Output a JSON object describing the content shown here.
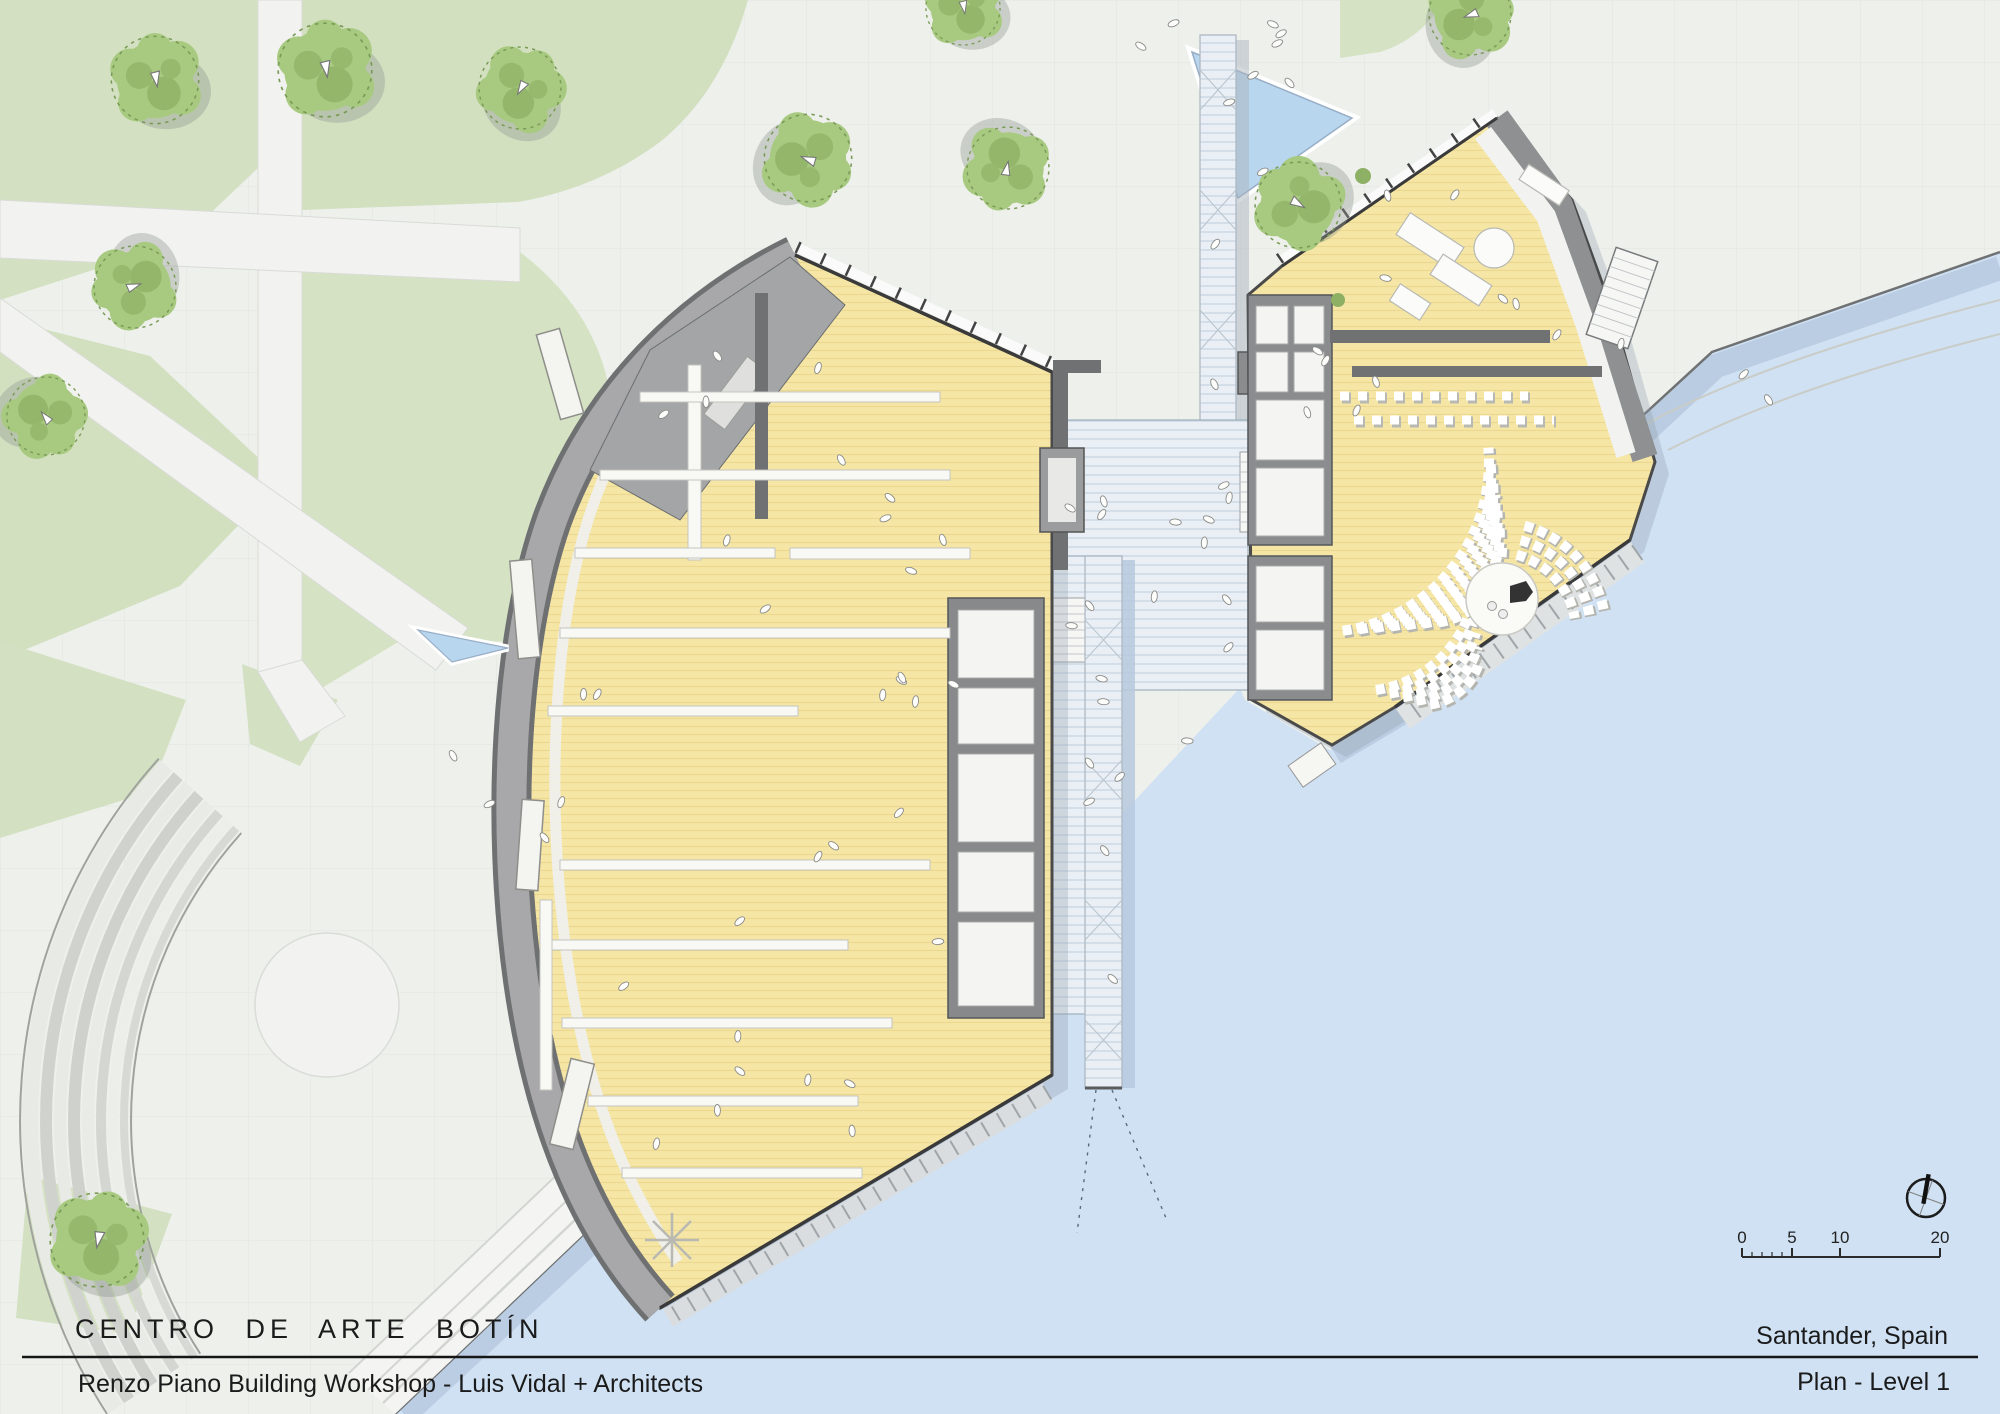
{
  "title_block": {
    "project": "CENTRO DE ARTE BOTÍN",
    "architects": "Renzo Piano Building Workshop - Luis Vidal + Architects",
    "location": "Santander, Spain",
    "sheet": "Plan - Level 1"
  },
  "scale_bar": {
    "unit_labels": [
      "0",
      "5",
      "10",
      "20"
    ]
  },
  "compass": {
    "icon": "north-arrow-icon"
  },
  "palette": {
    "paper": "#eef0ec",
    "paving_grid": "#e3e5e0",
    "lawn": "#d3e1c2",
    "tree_canopy": "#a8ca80",
    "water": "#cfe1f3",
    "water_shadow": "#b7c9de",
    "pool": "#b9d6ef",
    "gallery_floor": "#f5e6a5",
    "wall_dark": "#4a4a4a",
    "roof_gray": "#a8a8aa",
    "glass_deck": "#e9eff4",
    "seating_white": "#ffffff"
  }
}
